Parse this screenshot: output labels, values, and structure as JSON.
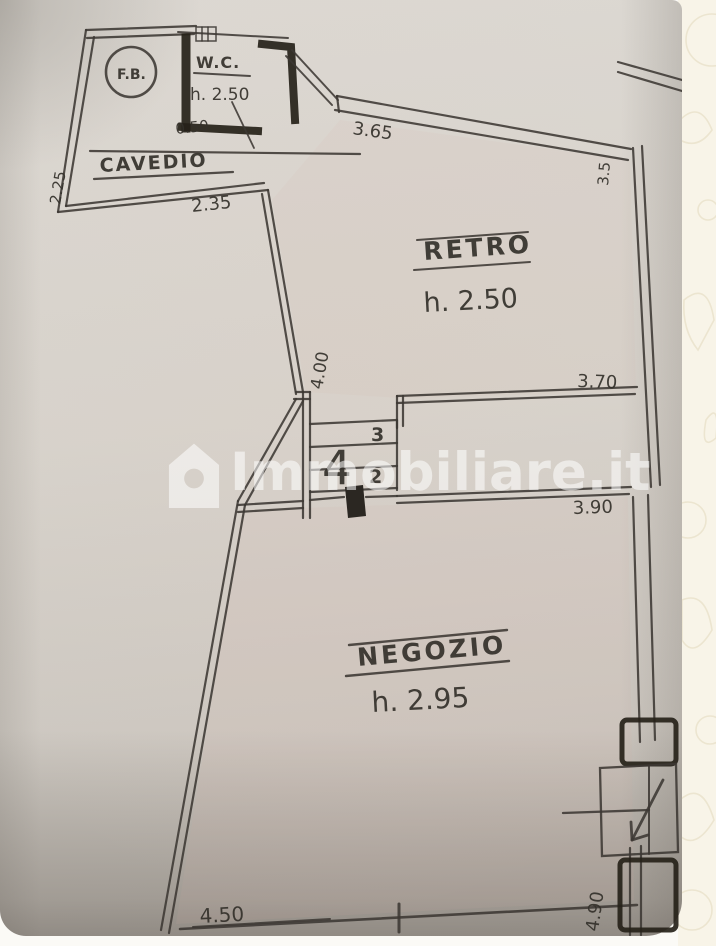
{
  "watermark": {
    "brand": "Immobiliare.it"
  },
  "plan": {
    "reference_marker": "F.B.",
    "rooms": {
      "wc": {
        "label": "W.C.",
        "height": "h. 2.50"
      },
      "cavedio": {
        "label": "CAVEDIO"
      },
      "retro": {
        "label": "RETRO",
        "height": "h. 2.50"
      },
      "negozio": {
        "label": "NEGOZIO",
        "height": "h. 2.95"
      }
    },
    "stairs": {
      "steps": {
        "top": "3",
        "middle": "2",
        "big": "4"
      }
    },
    "dimensions": {
      "wc_width": "0.50",
      "cavedio_left": "2.25",
      "cavedio_bottom": "2.35",
      "retro_top": "3.65",
      "retro_right": "3.5",
      "retro_left": "4.00",
      "retro_bottom": "3.70",
      "negozio_top": "3.90",
      "negozio_bottom": "4.50",
      "negozio_right": "4.90"
    }
  },
  "colors": {
    "ink": "#3c3833",
    "paper": "#d7d3cc",
    "background_strip": "#f8f4e8",
    "watermark": "rgba(255,255,255,0.55)"
  }
}
